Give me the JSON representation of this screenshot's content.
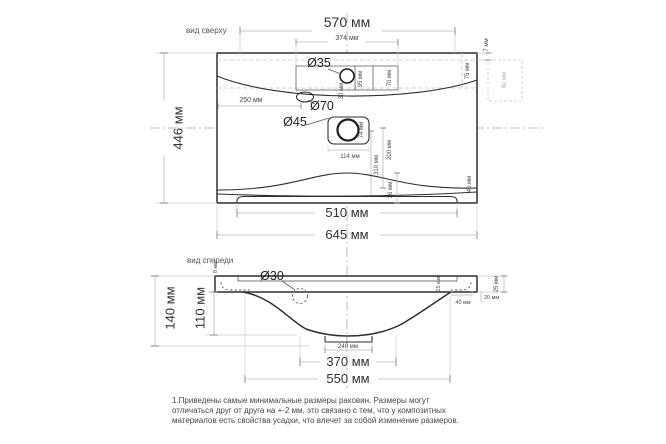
{
  "colors": {
    "background": "#ffffff",
    "outline": "#2e2e2e",
    "dimension_line": "#b8b8b8",
    "dimension_text": "#3b3b3b",
    "ghost": "#c6c6c6"
  },
  "top_view": {
    "title": "вид сверху",
    "holes": {
      "faucet": "Ø35",
      "overflow": "Ø70",
      "drain": "Ø45"
    },
    "dims": {
      "d570": "570 мм",
      "d374": "374 мм",
      "d446": "446 мм",
      "d645": "645 мм",
      "d510": "510 мм",
      "d250": "250 мм",
      "d7": "7 мм",
      "d75": "75 мм",
      "d80": "80 мм",
      "d95": "95 мм",
      "d70": "70 мм",
      "d30": "30 мм",
      "d74": "74 мм",
      "d114": "114 мм",
      "d310": "310 мм",
      "d200": "200 мм",
      "d36": "36 мм",
      "d40": "40 мм"
    }
  },
  "front_view": {
    "title": "вид спереди",
    "holes": {
      "siphon": "Ø30"
    },
    "dims": {
      "d140": "140 мм",
      "d110": "110 мм",
      "d8": "8 мм",
      "d15": "15 мм",
      "d25": "25 мм",
      "d20": "20 мм",
      "d40": "40 мм",
      "d240": "240 мм",
      "d370": "370 мм",
      "d550": "550 мм"
    }
  },
  "note": {
    "line1": "1.Приведены самые минимальные размеры раковин. Размеры могут",
    "line2": "отличаться друг от друга на +-2 мм, это связано с тем, что у композитных",
    "line3": "материалов есть свойства усадки, что влечет за собой изменение размеров."
  }
}
